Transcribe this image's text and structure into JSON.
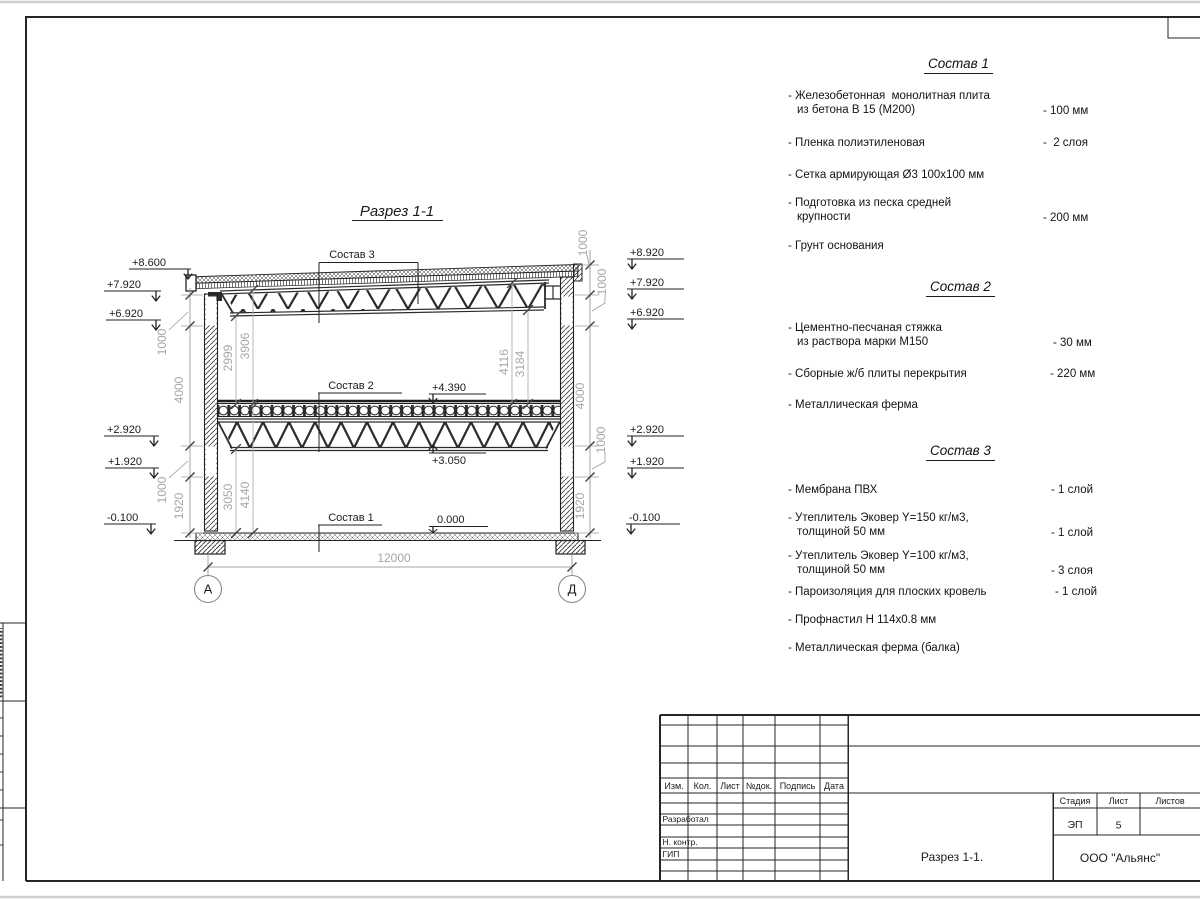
{
  "drawing": {
    "title": "Разрез 1-1",
    "span": "12000",
    "axes": [
      "А",
      "Д"
    ],
    "callouts": [
      "Состав 3",
      "Состав 2",
      "Состав 1"
    ],
    "elev_left": [
      "+8.600",
      "+7.920",
      "+6.920",
      "+2.920",
      "+1.920",
      "-0.100"
    ],
    "elev_right": [
      "+8.920",
      "+7.920",
      "+6.920",
      "+2.920",
      "+1.920",
      "-0.100"
    ],
    "marks": {
      "slab_top": "+4.390",
      "truss_bottom": "+3.050",
      "floor_zero": "0.000"
    },
    "dims_left": [
      "1000",
      "4000",
      "1000",
      "1920"
    ],
    "dims_right": [
      "1000",
      "1000",
      "4000",
      "1000",
      "1920"
    ],
    "dims_inner": [
      "2999",
      "3906",
      "4116",
      "3184",
      "3050",
      "4140"
    ]
  },
  "compositions": [
    {
      "title": "Состав 1",
      "items": [
        {
          "l1": "- Железобетонная  монолитная плита",
          "l2": "из бетона В 15 (М200)",
          "value": "- 100 мм"
        },
        {
          "l1": "- Пленка полиэтиленовая",
          "value": "-  2 слоя"
        },
        {
          "l1": "- Сетка армирующая Ø3 100х100 мм"
        },
        {
          "l1": "- Подготовка из песка средней",
          "l2": "крупности",
          "value": "- 200 мм"
        },
        {
          "l1": "- Грунт основания"
        }
      ]
    },
    {
      "title": "Состав 2",
      "items": [
        {
          "l1": "- Цементно-песчаная стяжка",
          "l2": "из раствора марки М150",
          "value": "- 30 мм"
        },
        {
          "l1": "- Сборные ж/б плиты перекрытия",
          "value": "- 220 мм"
        },
        {
          "l1": "- Металлическая ферма"
        }
      ]
    },
    {
      "title": "Состав 3",
      "items": [
        {
          "l1": "- Мембрана ПВХ",
          "value": "- 1 слой"
        },
        {
          "l1": "- Утеплитель Эковер Y=150 кг/м3,",
          "l2": "толщиной 50 мм",
          "value": "- 1 слой"
        },
        {
          "l1": "- Утеплитель Эковер Y=100 кг/м3,",
          "l2": "толщиной 50 мм",
          "value": "- 3 слоя"
        },
        {
          "l1": "- Пароизоляция для плоских кровель",
          "value": "- 1 слой"
        },
        {
          "l1": "- Профнастил Н 114х0.8 мм"
        },
        {
          "l1": "- Металлическая ферма (балка)"
        }
      ]
    }
  ],
  "titleblock": {
    "cols": [
      "Изм.",
      "Кол.",
      "Лист",
      "№док.",
      "Подпись",
      "Дата"
    ],
    "roles": [
      "Разработал",
      "Н. контр.",
      "ГИП"
    ],
    "stage_label": "Стадия",
    "sheet_label": "Лист",
    "sheets_label": "Листов",
    "stage": "ЭП",
    "sheet": "5",
    "doc_title": "Разрез  1-1.",
    "company": "ООО \"Альянс\""
  }
}
